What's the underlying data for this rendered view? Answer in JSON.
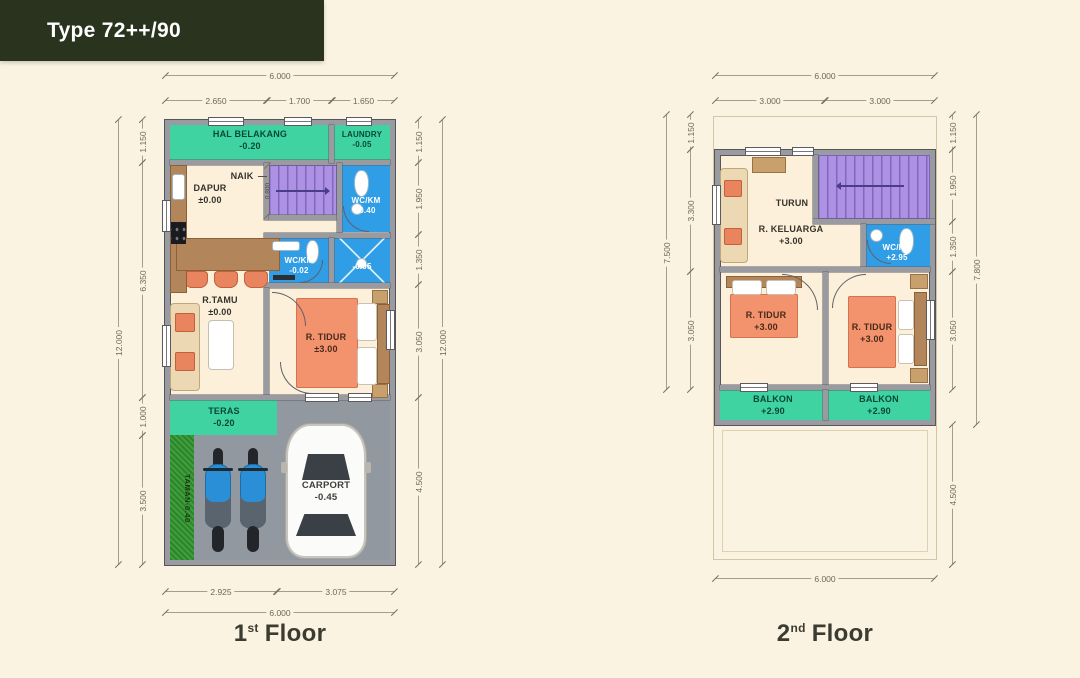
{
  "title": "Type 72++/90",
  "colors": {
    "background": "#fbf3e2",
    "badge_green": "#29331e",
    "room_green": "#3fd3a1",
    "stair_purple": "#ad91e2",
    "wet_blue": "#2f9ee6",
    "wall_gray": "#9a9ba1",
    "floor_cream": "#fcf0da",
    "carport_gray": "#9298a0",
    "grass_green": "#3f9f3c",
    "bed_orange": "#f2936d",
    "wood_brown": "#b3855a",
    "sofa_beige": "#ecd8b2"
  },
  "floor1": {
    "caption": {
      "num": "1",
      "sup": "st",
      "word": "Floor"
    },
    "rooms": {
      "hal_belakang": {
        "name": "HAL BELAKANG",
        "level": "-0.20"
      },
      "laundry": {
        "name": "LAUNDRY",
        "level": "-0.05"
      },
      "dapur": {
        "name": "DAPUR",
        "level": "±0.00"
      },
      "naik": {
        "name": "NAIK"
      },
      "wc_km_atas": {
        "name": "WC/KM",
        "level": "-0.40"
      },
      "wc_km_tengah": {
        "name": "WC/KM",
        "level": "-0.02"
      },
      "shower": {
        "level": "-0.05"
      },
      "r_tamu": {
        "name": "R.TAMU",
        "level": "±0.00"
      },
      "r_tidur": {
        "name": "R. TIDUR",
        "level": "±3.00"
      },
      "teras": {
        "name": "TERAS",
        "level": "-0.20"
      },
      "taman": {
        "name": "TAMAN",
        "level": "-0.40"
      },
      "carport": {
        "name": "CARPORT",
        "level": "-0.45"
      }
    },
    "dims": {
      "top_total": "6.000",
      "top_seg1": "2.650",
      "top_seg2": "1.700",
      "top_seg3": "1.650",
      "left_total": "12.000",
      "left_seg1": "1.150",
      "left_seg2": "6.350",
      "left_seg3": "1.000",
      "left_seg4": "3.500",
      "right_seg1": "1.150",
      "right_seg2": "1.950",
      "right_seg3": "1.350",
      "right_seg4": "3.050",
      "right_seg5": "4.500",
      "right_total": "12.000",
      "bottom_seg1": "2.925",
      "bottom_seg2": "3.075",
      "bottom_total": "6.000",
      "stair_width": "0.800"
    }
  },
  "floor2": {
    "caption": {
      "num": "2",
      "sup": "nd",
      "word": "Floor"
    },
    "rooms": {
      "turun": {
        "name": "TURUN"
      },
      "r_keluarga": {
        "name": "R. KELUARGA",
        "level": "+3.00"
      },
      "wc_km": {
        "name": "WC/KM",
        "level": "+2.95"
      },
      "r_tidur_kiri": {
        "name": "R. TIDUR",
        "level": "+3.00"
      },
      "r_tidur_kanan": {
        "name": "R. TIDUR",
        "level": "+3.00"
      },
      "balkon_kiri": {
        "name": "BALKON",
        "level": "+2.90"
      },
      "balkon_kanan": {
        "name": "BALKON",
        "level": "+2.90"
      }
    },
    "dims": {
      "top_total": "6.000",
      "top_seg1": "3.000",
      "top_seg2": "3.000",
      "left_seg1": "1.150",
      "left_seg2": "3.300",
      "left_seg3": "3.050",
      "left_total": "7.500",
      "right_seg1": "1.150",
      "right_seg2": "1.950",
      "right_seg3": "1.350",
      "right_seg4": "3.050",
      "right_total": "7.800",
      "right_seg5": "4.500",
      "bottom_total": "6.000"
    }
  }
}
